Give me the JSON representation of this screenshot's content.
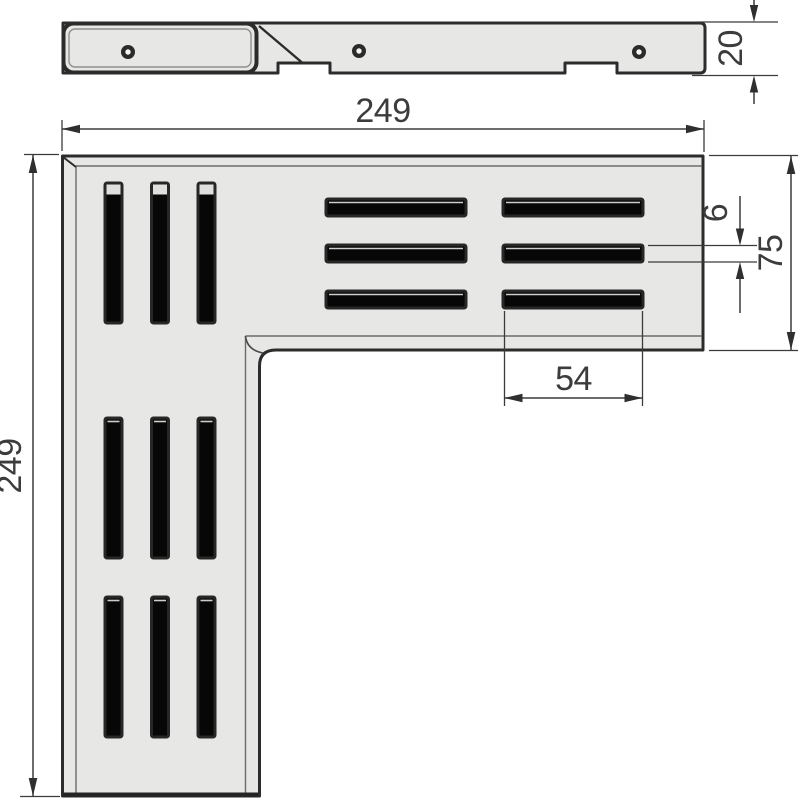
{
  "drawing": {
    "type": "technical-drawing",
    "subject": "L-shaped corner drain grate, profile view and plan view",
    "colors": {
      "background": "#ffffff",
      "plate_fill": "#e7e7e5",
      "outline": "#2c2c2c",
      "slot_fill": "#070707",
      "bevel_line": "#6b6b69",
      "dimension_line": "#3b3b3b",
      "text": "#3c3c3c"
    },
    "dim_labels": {
      "top_width": "249",
      "left_height": "249",
      "profile_thickness": "20",
      "slot_width": "6",
      "arm_width": "75",
      "slot_length": "54"
    },
    "profile_view": {
      "holes": [
        {
          "cx": 128,
          "cy": 52
        },
        {
          "cx": 359,
          "cy": 51
        },
        {
          "cx": 639,
          "cy": 52
        }
      ]
    },
    "main_view": {
      "vertical_slots": {
        "cols": [
          105,
          151.5,
          198
        ],
        "width": 17,
        "length": 140,
        "groups": [
          {
            "y": 183,
            "cap": true
          },
          {
            "y": 418,
            "cap": false
          },
          {
            "y": 597,
            "cap": false
          }
        ]
      },
      "horizontal_slots": {
        "rows": [
          199,
          245,
          291
        ],
        "height": 17,
        "length": 140,
        "cols": [
          326,
          503
        ]
      }
    }
  }
}
